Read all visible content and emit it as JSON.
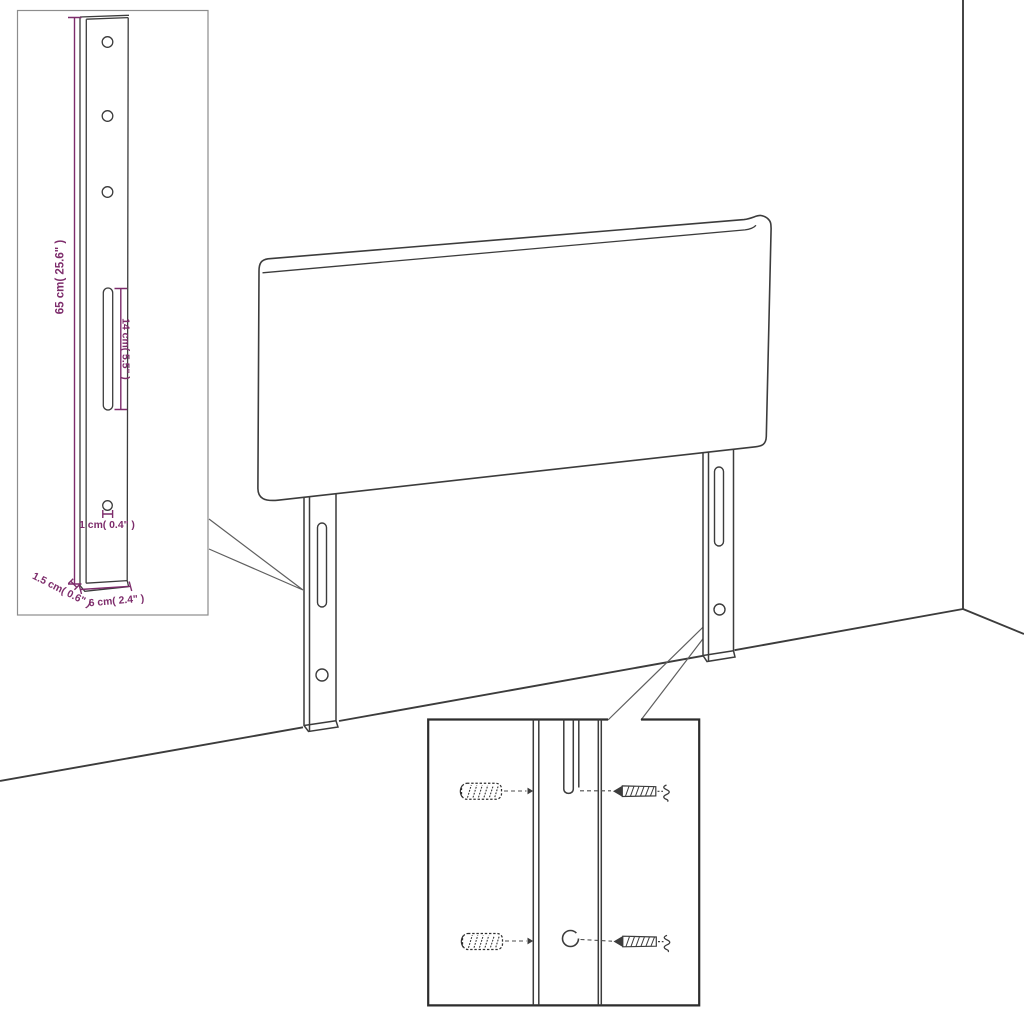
{
  "colors": {
    "background": "#ffffff",
    "line": "#3c3c3c",
    "callout": "#5f5f5f",
    "dashed_guide": "#4d4d4d",
    "detail_box_border": "#2d2d2d",
    "inset_box_border": "#8d8d8d",
    "dimension": "#7d2c6b"
  },
  "inset_panel": {
    "labels": {
      "height": "65 cm( 25.6\" )",
      "slot_length": "14 cm( 5.5\" )",
      "hole_diameter": "1 cm( 0.4\" )",
      "thickness": "1.5 cm( 0.6\" )",
      "width": "6 cm( 2.4\" )"
    }
  }
}
